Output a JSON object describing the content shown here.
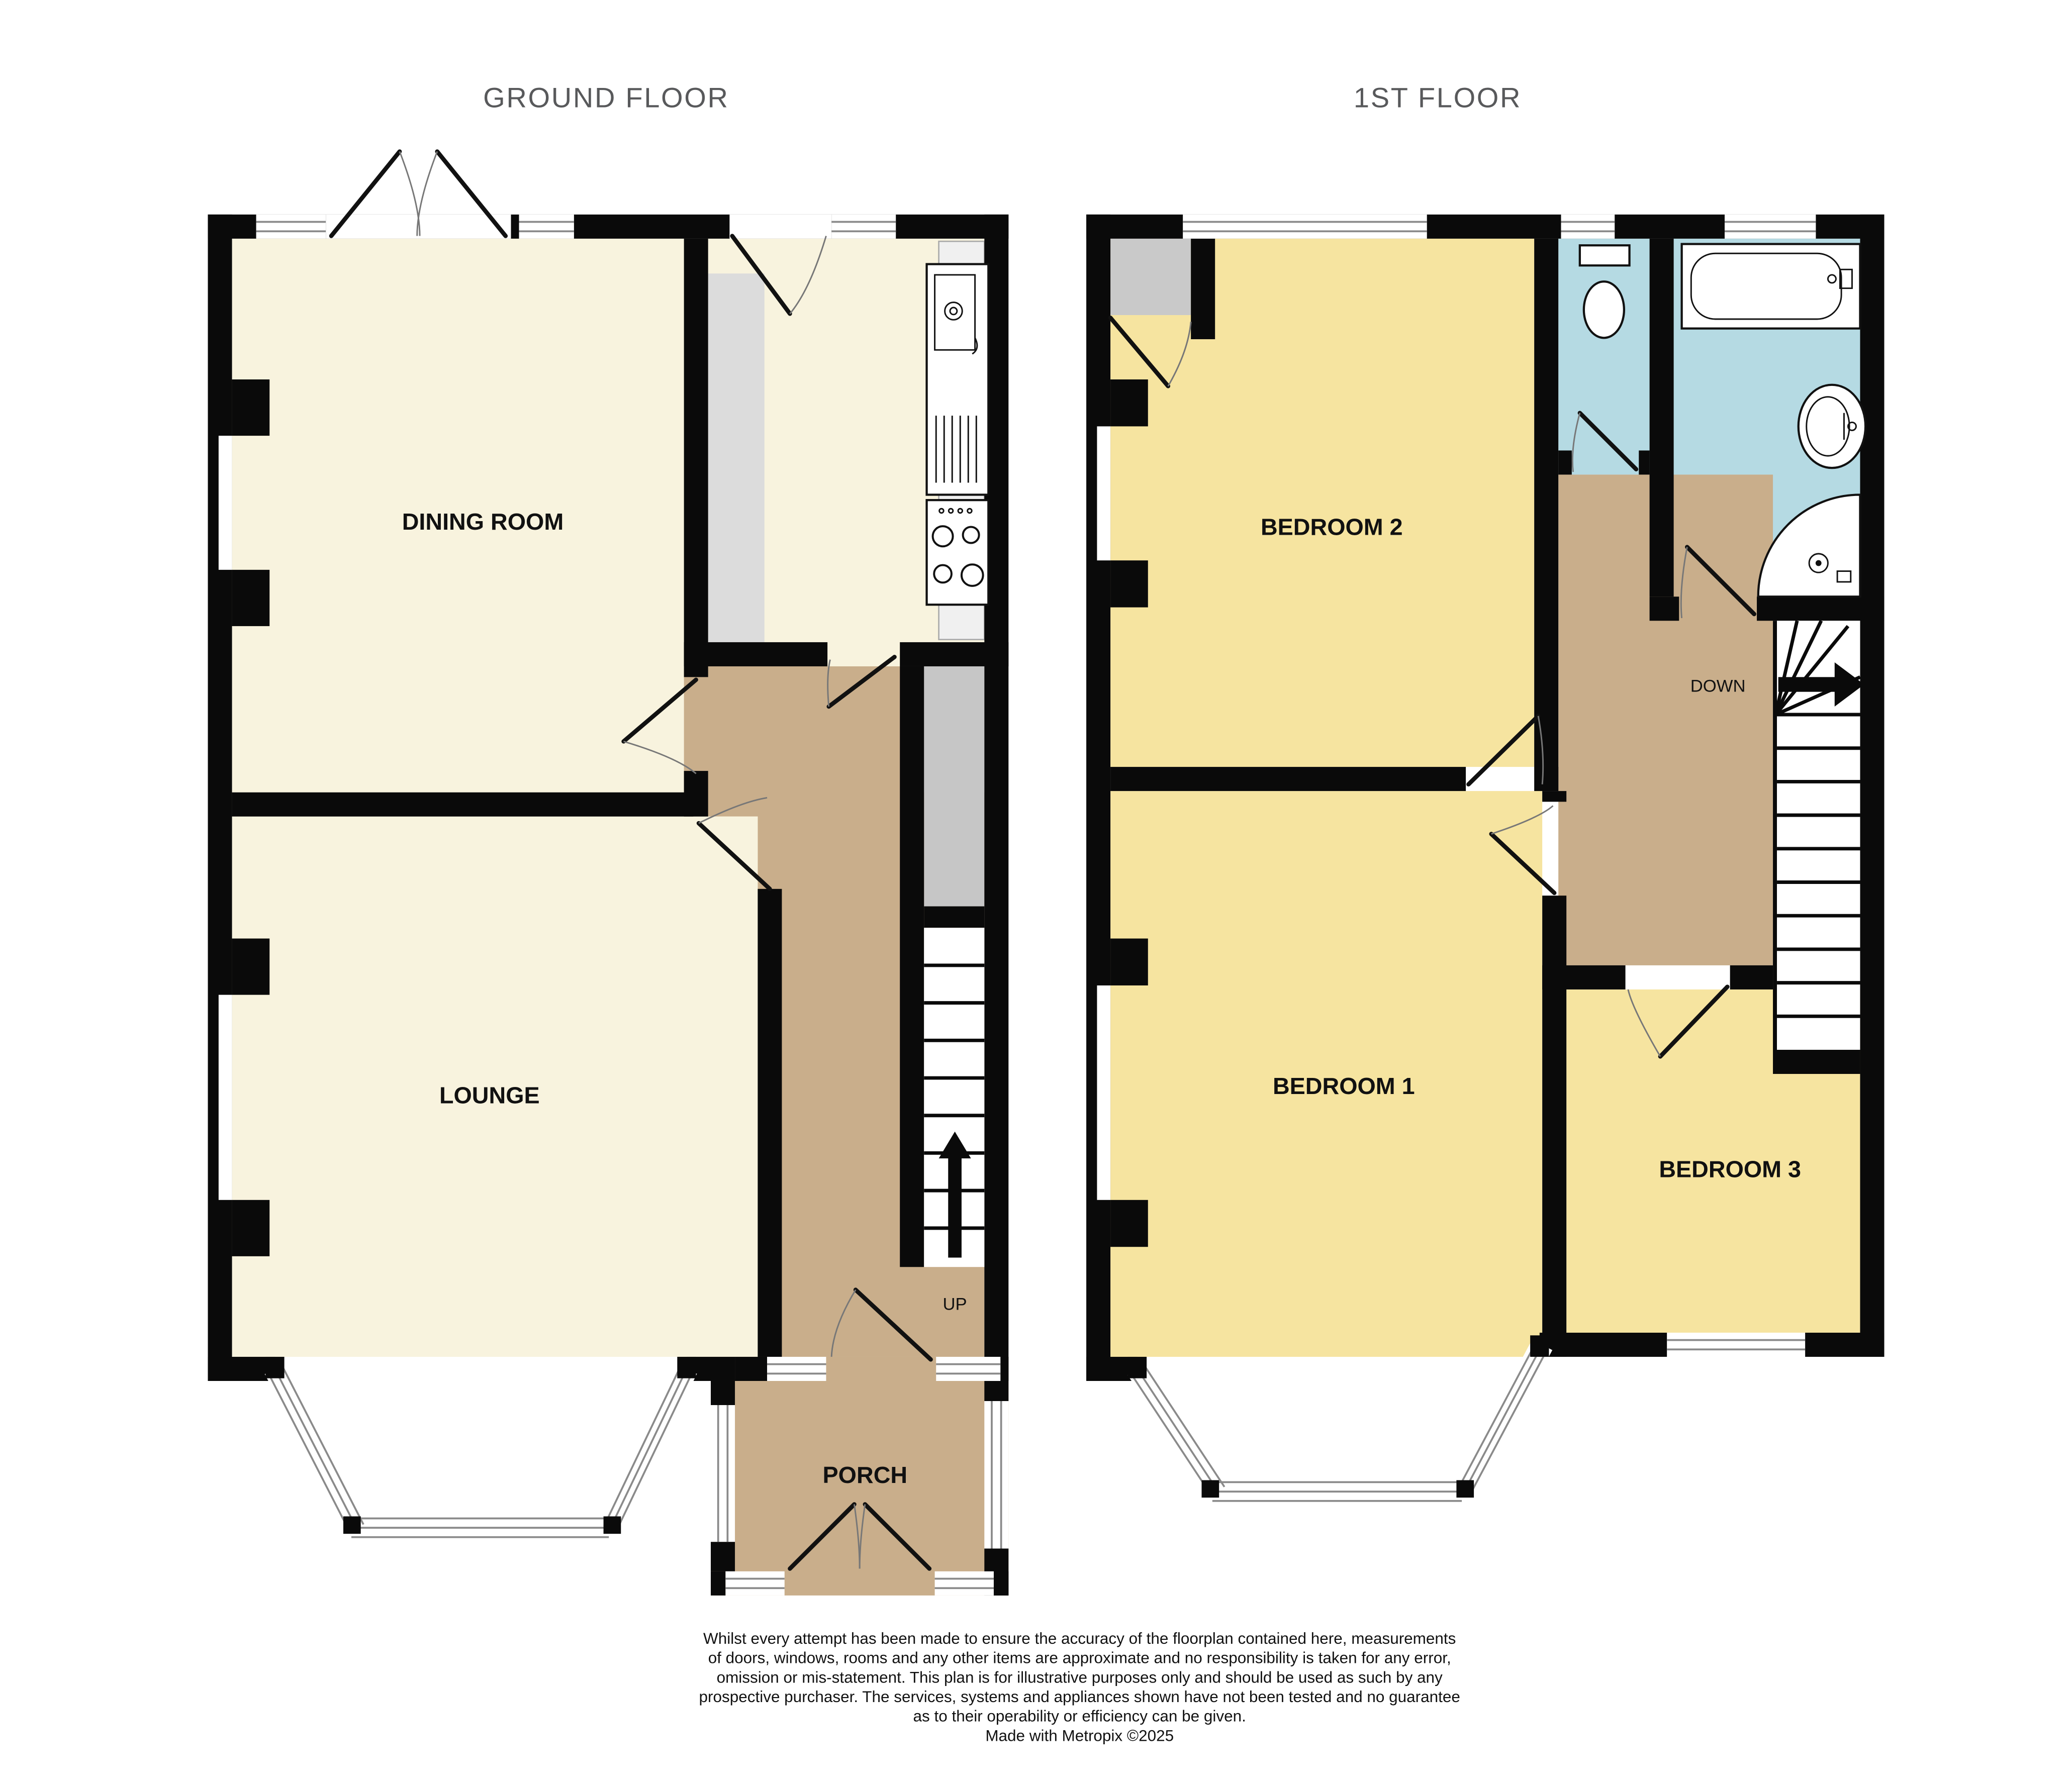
{
  "titles": {
    "ground_floor": "GROUND FLOOR",
    "first_floor": "1ST FLOOR"
  },
  "ground_floor": {
    "rooms": [
      {
        "label": "DINING ROOM"
      },
      {
        "label": "LOUNGE"
      },
      {
        "label": "PORCH"
      }
    ],
    "stairs_label": "UP"
  },
  "first_floor": {
    "rooms": [
      {
        "label": "BEDROOM 2"
      },
      {
        "label": "BEDROOM 1"
      },
      {
        "label": "BEDROOM 3"
      }
    ],
    "stairs_label": "DOWN"
  },
  "colors": {
    "wall": "#0a0a0a",
    "ground_room_floor": "#f8f3de",
    "bedroom_floor": "#f6e4a0",
    "hallway_floor": "#c9ae8b",
    "bathroom_floor": "#b5dae3",
    "closet_gray": "#c9c9c9",
    "counter_gray": "#dcdcdc",
    "title_gray": "#58595b"
  },
  "disclaimer": {
    "lines": [
      "Whilst every attempt has been made to ensure the accuracy of the floorplan contained here, measurements",
      "of doors, windows, rooms and any other items are approximate and no responsibility is taken for any error,",
      "omission or mis-statement. This plan is for illustrative purposes only and should be used as such by any",
      "prospective purchaser. The services, systems and appliances shown have not been tested and no guarantee",
      "as to their operability or efficiency can be given."
    ],
    "credit": "Made with Metropix ©2025"
  }
}
